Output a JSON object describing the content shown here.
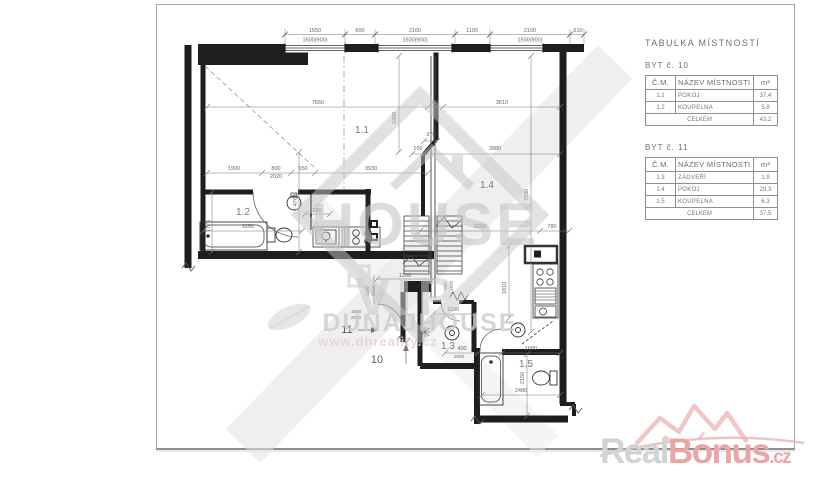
{
  "drawing": {
    "dims_top": {
      "d1": "1550",
      "d1b": "1500(900)",
      "d2": "600",
      "d3": "2160",
      "d3b": "1500(900)",
      "d4": "1100",
      "d5": "2100",
      "d5b": "1500(900)",
      "d6": "610"
    },
    "dims": {
      "d7650": "7650",
      "d100a": "100",
      "d3610": "3610",
      "d2400": "2400",
      "d1900": "1900",
      "d800a": "800",
      "d2020a": "2020",
      "d650": "650",
      "d3930": "3930",
      "d100b": "100",
      "d3980": "3980",
      "d370": "370",
      "d7930": "7930",
      "d4760": "4760",
      "d1775": "1775",
      "d3250": "3250",
      "d280": "280",
      "d1200": "1200",
      "d3200": "3200",
      "d780": "780",
      "d1810": "1810",
      "d1030": "1030",
      "d1000a": "1000",
      "d2010a": "2010",
      "d1000b": "1000",
      "d2010b": "2010",
      "d900": "900",
      "d1970": "1970",
      "d400": "400",
      "d2020b": "2020",
      "d1680": "1680",
      "d2150": "2150",
      "d2480": "2480"
    },
    "rooms": {
      "r1": "1.1",
      "r2": "1.2",
      "r3": "1.3",
      "r4": "1.4",
      "r5": "1.5"
    },
    "units": {
      "u10": "10",
      "u11": "11"
    }
  },
  "tables": {
    "title": "TABULKA MÍSTNOSTÍ",
    "byt10": {
      "heading": "BYT č. 10",
      "col_cm": "Č.M.",
      "col_name": "NÁZEV MÍSTNOSTI",
      "col_area": "m²",
      "rows": [
        {
          "cm": "1.1",
          "name": "POKOJ",
          "area": "37.4"
        },
        {
          "cm": "1.2",
          "name": "KOUPELNA",
          "area": "5.8"
        }
      ],
      "total_label": "CELKEM",
      "total": "43.2"
    },
    "byt11": {
      "heading": "BYT č. 11",
      "col_cm": "Č.M.",
      "col_name": "NÁZEV MÍSTNOSTI",
      "col_area": "m²",
      "rows": [
        {
          "cm": "1.3",
          "name": "ZÁDVEŘÍ",
          "area": "1.9"
        },
        {
          "cm": "1.4",
          "name": "POKOJ",
          "area": "29.3"
        },
        {
          "cm": "1.5",
          "name": "KOUPELNA",
          "area": "6.3"
        }
      ],
      "total_label": "CELKEM",
      "total": "37.5"
    }
  },
  "watermark": {
    "house": "HOUSE",
    "vip": "VIP",
    "brand": "DUNAJHOUSE",
    "reg": "®",
    "url": "www.dhreality.cz"
  },
  "brand_logo": {
    "real": "Real",
    "bonus": "Bonus",
    "cz": ".cz"
  },
  "colors": {
    "wall": "#1e1e1e",
    "dim_line": "#777777",
    "dim_text": "#666666",
    "watermark_gray": "#c9c9c9",
    "logo_pink": "#eaa6a6",
    "frame": "#a7a7a7"
  }
}
